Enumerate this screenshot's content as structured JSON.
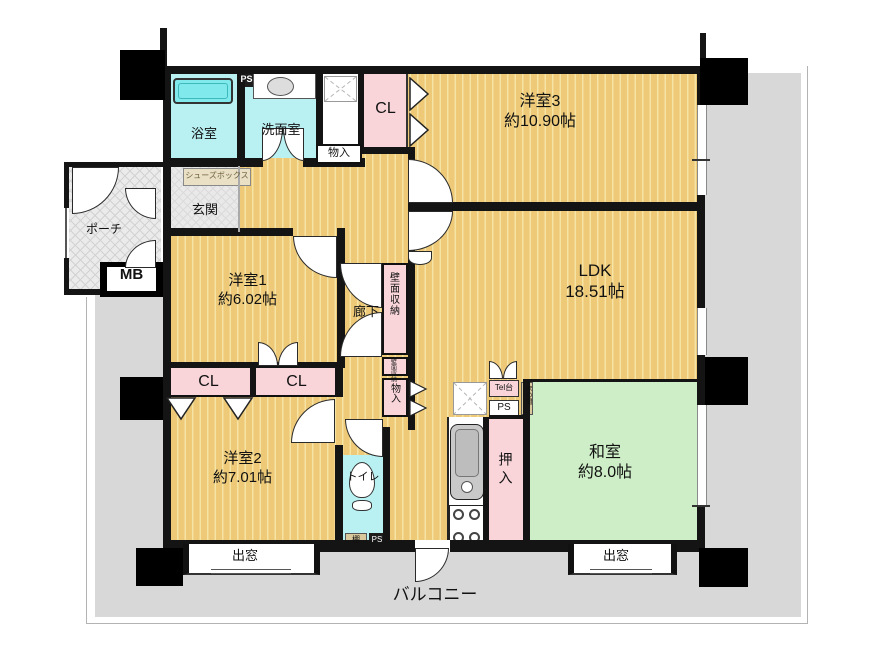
{
  "rooms": {
    "yoshitsu3": {
      "name": "洋室3",
      "size": "約10.90帖"
    },
    "ldk": {
      "name": "LDK",
      "size": "18.51帖"
    },
    "washitsu": {
      "name": "和室",
      "size": "約8.0帖"
    },
    "yoshitsu1": {
      "name": "洋室1",
      "size": "約6.02帖"
    },
    "yoshitsu2": {
      "name": "洋室2",
      "size": "約7.01帖"
    },
    "bath": "浴室",
    "washroom": "洗面室",
    "toilet": "トイレ",
    "corridor": "廊下",
    "genkan": "玄関",
    "porch": "ポーチ",
    "balcony": "バルコニー"
  },
  "storage": {
    "cl": "CL",
    "monoire": "物入",
    "hekimen": "壁面収納",
    "oshiire": "押入",
    "shoebox": "シューズボックス",
    "tana": "棚",
    "tokonoma": "床の間"
  },
  "fixtures": {
    "mb": "MB",
    "ps": "PS",
    "tel": "Tel台",
    "demado": "出窓"
  },
  "colors": {
    "floor": "#edc978",
    "floor_stripe": "#f6e4a5",
    "tatami": "#cdeec6",
    "water": "#b9f1f3",
    "closet": "#f9d5da",
    "balcony": "#d8d8d8",
    "wall": "#141414"
  }
}
